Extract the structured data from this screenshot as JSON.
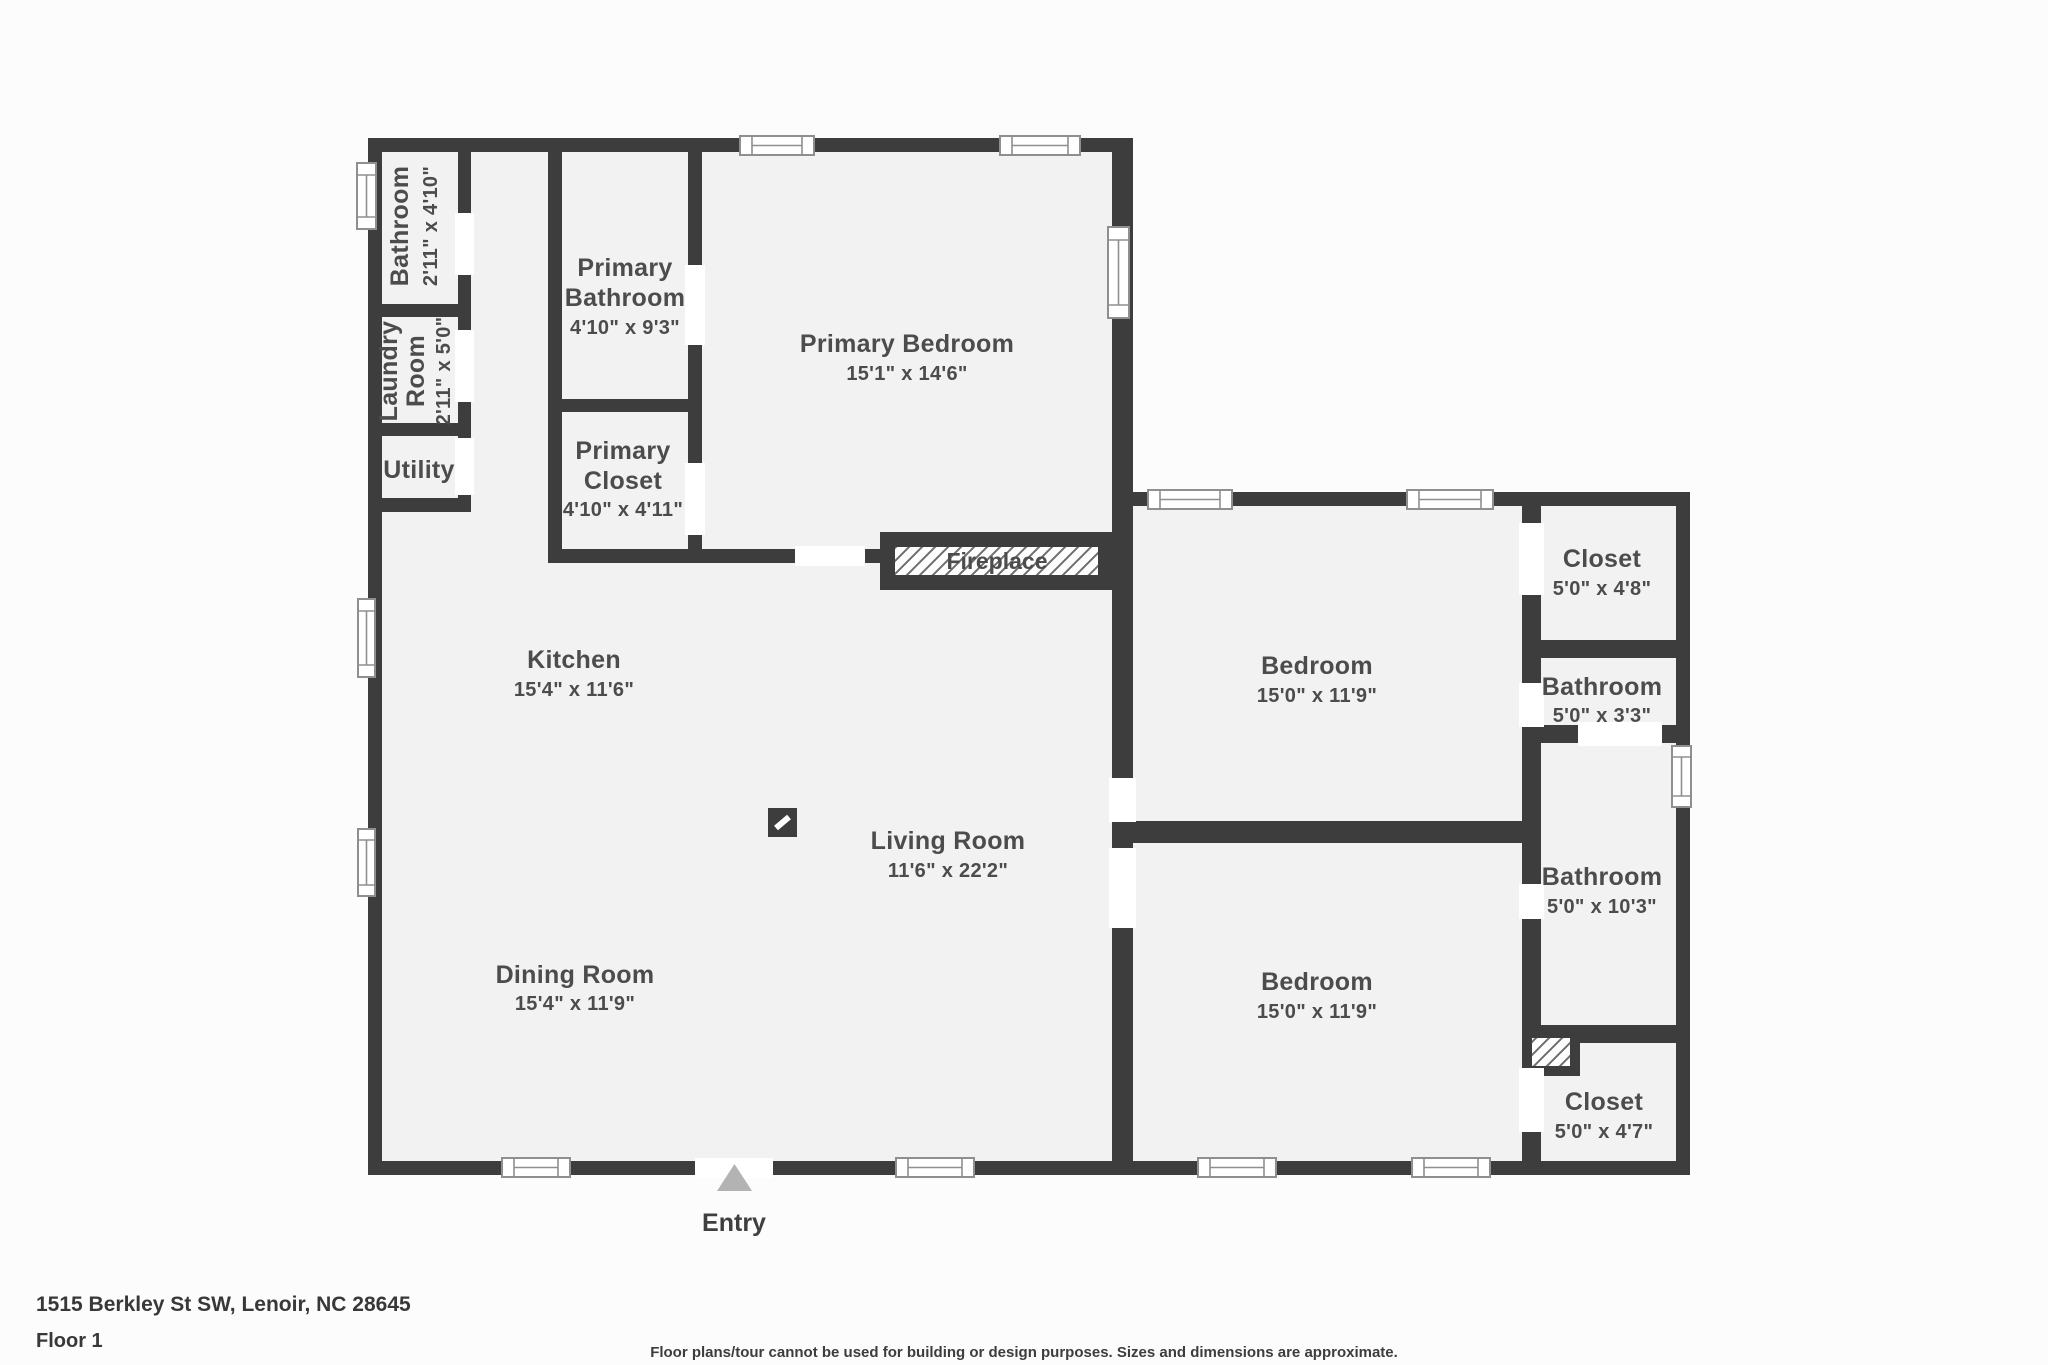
{
  "page": {
    "background": "#fcfcfc",
    "wall_color": "#3d3d3d",
    "room_fill": "#f2f2f2",
    "address": "1515 Berkley St SW, Lenoir, NC 28645",
    "floor_label": "Floor 1",
    "disclaimer": "Floor plans/tour cannot be used for building or design purposes. Sizes and dimensions are approximate."
  },
  "entry": {
    "label": "Entry"
  },
  "fireplace": {
    "label": "Fireplace"
  },
  "rooms": {
    "bathroom_tl": {
      "name": "Bathroom",
      "dims": "2'11\" x 4'10\""
    },
    "laundry": {
      "name_line1": "Laundry",
      "name_line2": "Room",
      "dims": "2'11\" x 5'0\""
    },
    "utility": {
      "name": "Utility"
    },
    "primary_bathroom": {
      "name_line1": "Primary",
      "name_line2": "Bathroom",
      "dims": "4'10\" x 9'3\""
    },
    "primary_closet": {
      "name_line1": "Primary",
      "name_line2": "Closet",
      "dims": "4'10\" x 4'11\""
    },
    "primary_bedroom": {
      "name": "Primary Bedroom",
      "dims": "15'1\" x 14'6\""
    },
    "kitchen": {
      "name": "Kitchen",
      "dims": "15'4\" x 11'6\""
    },
    "dining": {
      "name": "Dining Room",
      "dims": "15'4\" x 11'9\""
    },
    "living": {
      "name": "Living Room",
      "dims": "11'6\" x 22'2\""
    },
    "bedroom_top": {
      "name": "Bedroom",
      "dims": "15'0\" x 11'9\""
    },
    "bedroom_bottom": {
      "name": "Bedroom",
      "dims": "15'0\" x 11'9\""
    },
    "closet_top": {
      "name": "Closet",
      "dims": "5'0\" x 4'8\""
    },
    "bathroom_small": {
      "name": "Bathroom",
      "dims": "5'0\" x 3'3\""
    },
    "bathroom_tall": {
      "name": "Bathroom",
      "dims": "5'0\" x 10'3\""
    },
    "closet_bottom": {
      "name": "Closet",
      "dims": "5'0\" x 4'7\""
    }
  }
}
